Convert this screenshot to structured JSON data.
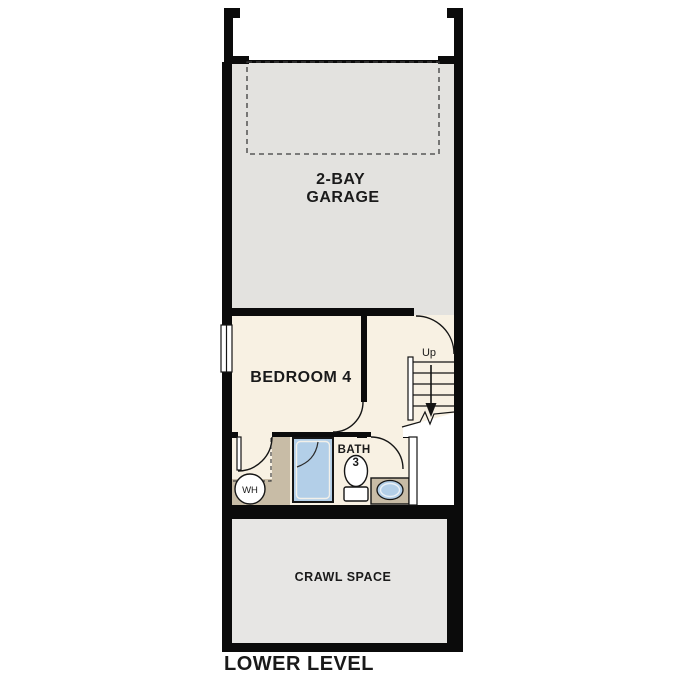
{
  "plan": {
    "level_label": "LOWER LEVEL",
    "garage": {
      "label_line1": "2-BAY",
      "label_line2": "GARAGE"
    },
    "bedroom": {
      "label": "BEDROOM 4"
    },
    "bath": {
      "label_line1": "BATH",
      "label_line2": "3"
    },
    "crawl_space": {
      "label": "CRAWL SPACE"
    },
    "stairs": {
      "direction_label": "Up"
    },
    "water_heater": {
      "label": "WH"
    },
    "colors": {
      "wall": "#0b0b0b",
      "garage_floor": "#e3e2df",
      "interior_floor": "#f8f1e3",
      "crawl_floor": "#e7e6e4",
      "cabinet_tan": "#c8bca6",
      "fixture_blue": "#b3cfe8",
      "wh_gray": "#d4d2cf",
      "text": "#1a1a1a"
    }
  }
}
